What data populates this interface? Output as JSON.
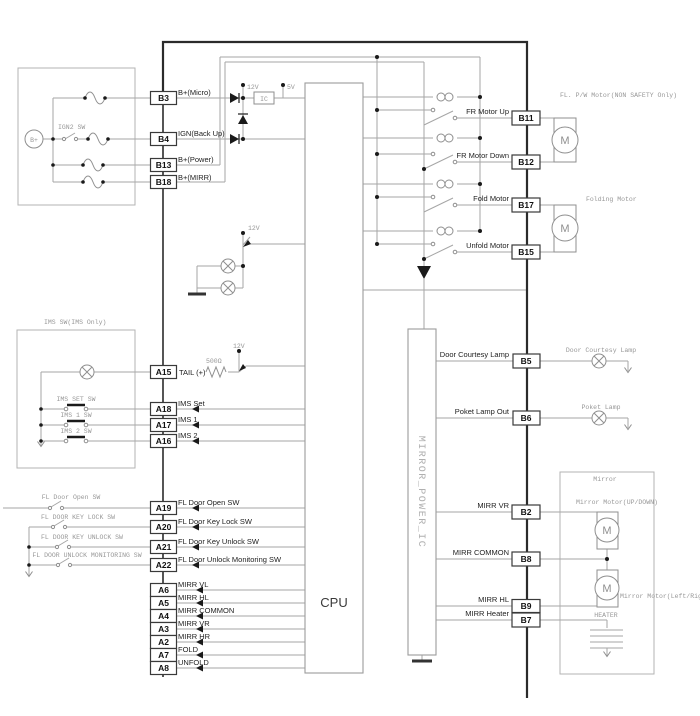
{
  "diagram": {
    "cpu": "CPU",
    "power_ic": "MIRROR_POWER_IC",
    "battery": "B+",
    "ign_switch": "IGN2 SW",
    "v12": "12V",
    "v5": "5V",
    "ic": "IC",
    "resistor": "500Ω",
    "motor_letter": "M",
    "lc": [
      {
        "id": "B3",
        "label": "B+(Micro)"
      },
      {
        "id": "B4",
        "label": "IGN(Back Up)"
      },
      {
        "id": "B13",
        "label": "B+(Power)"
      },
      {
        "id": "B18",
        "label": "B+(MIRR)"
      },
      {
        "id": "A15",
        "label": "TAIL (+)"
      },
      {
        "id": "A18",
        "label": "IMS Set"
      },
      {
        "id": "A17",
        "label": "IMS 1"
      },
      {
        "id": "A16",
        "label": "IMS 2"
      },
      {
        "id": "A19",
        "label": "FL Door Open SW"
      },
      {
        "id": "A20",
        "label": "FL Door Key Lock SW"
      },
      {
        "id": "A21",
        "label": "FL Door Key Unlock SW"
      },
      {
        "id": "A22",
        "label": "FL Door Unlock Monitoring SW"
      },
      {
        "id": "A6",
        "label": "MIRR VL"
      },
      {
        "id": "A5",
        "label": "MIRR HL"
      },
      {
        "id": "A4",
        "label": "MIRR COMMON"
      },
      {
        "id": "A3",
        "label": "MIRR VR"
      },
      {
        "id": "A2",
        "label": "MIRR HR"
      },
      {
        "id": "A7",
        "label": "FOLD"
      },
      {
        "id": "A8",
        "label": "UNFOLD"
      }
    ],
    "rc": [
      {
        "id": "B11",
        "label": "FR Motor Up"
      },
      {
        "id": "B12",
        "label": "FR Motor Down"
      },
      {
        "id": "B17",
        "label": "Fold Motor"
      },
      {
        "id": "B15",
        "label": "Unfold Motor"
      },
      {
        "id": "B5",
        "label": "Door Courtesy Lamp"
      },
      {
        "id": "B6",
        "label": "Poket Lamp Out"
      },
      {
        "id": "B2",
        "label": "MIRR VR"
      },
      {
        "id": "B8",
        "label": "MIRR COMMON"
      },
      {
        "id": "B9",
        "label": "MIRR HL"
      },
      {
        "id": "B7",
        "label": "MIRR Heater"
      }
    ],
    "ims": {
      "title": "IMS SW(IMS Only)",
      "sw": [
        "IMS SET SW",
        "IMS 1 SW",
        "IMS 2 SW"
      ]
    },
    "door_sw": [
      "FL Door Open SW",
      "FL DOOR KEY LOCK SW",
      "FL DOOR KEY UNLOCK SW",
      "FL DOOR UNLOCK MONITORING SW"
    ],
    "ann": {
      "fl_pw": "FL. P/W Motor(NON SAFETY Only)",
      "folding": "Folding Motor",
      "courtesy": "Door Courtesy Lamp",
      "poket": "Poket Lamp",
      "mirror": "Mirror",
      "mm_ud": "Mirror Motor(UP/DOWN)",
      "mm_lr": "Mirror Motor(Left/Right)",
      "heater": "HEATER"
    }
  }
}
